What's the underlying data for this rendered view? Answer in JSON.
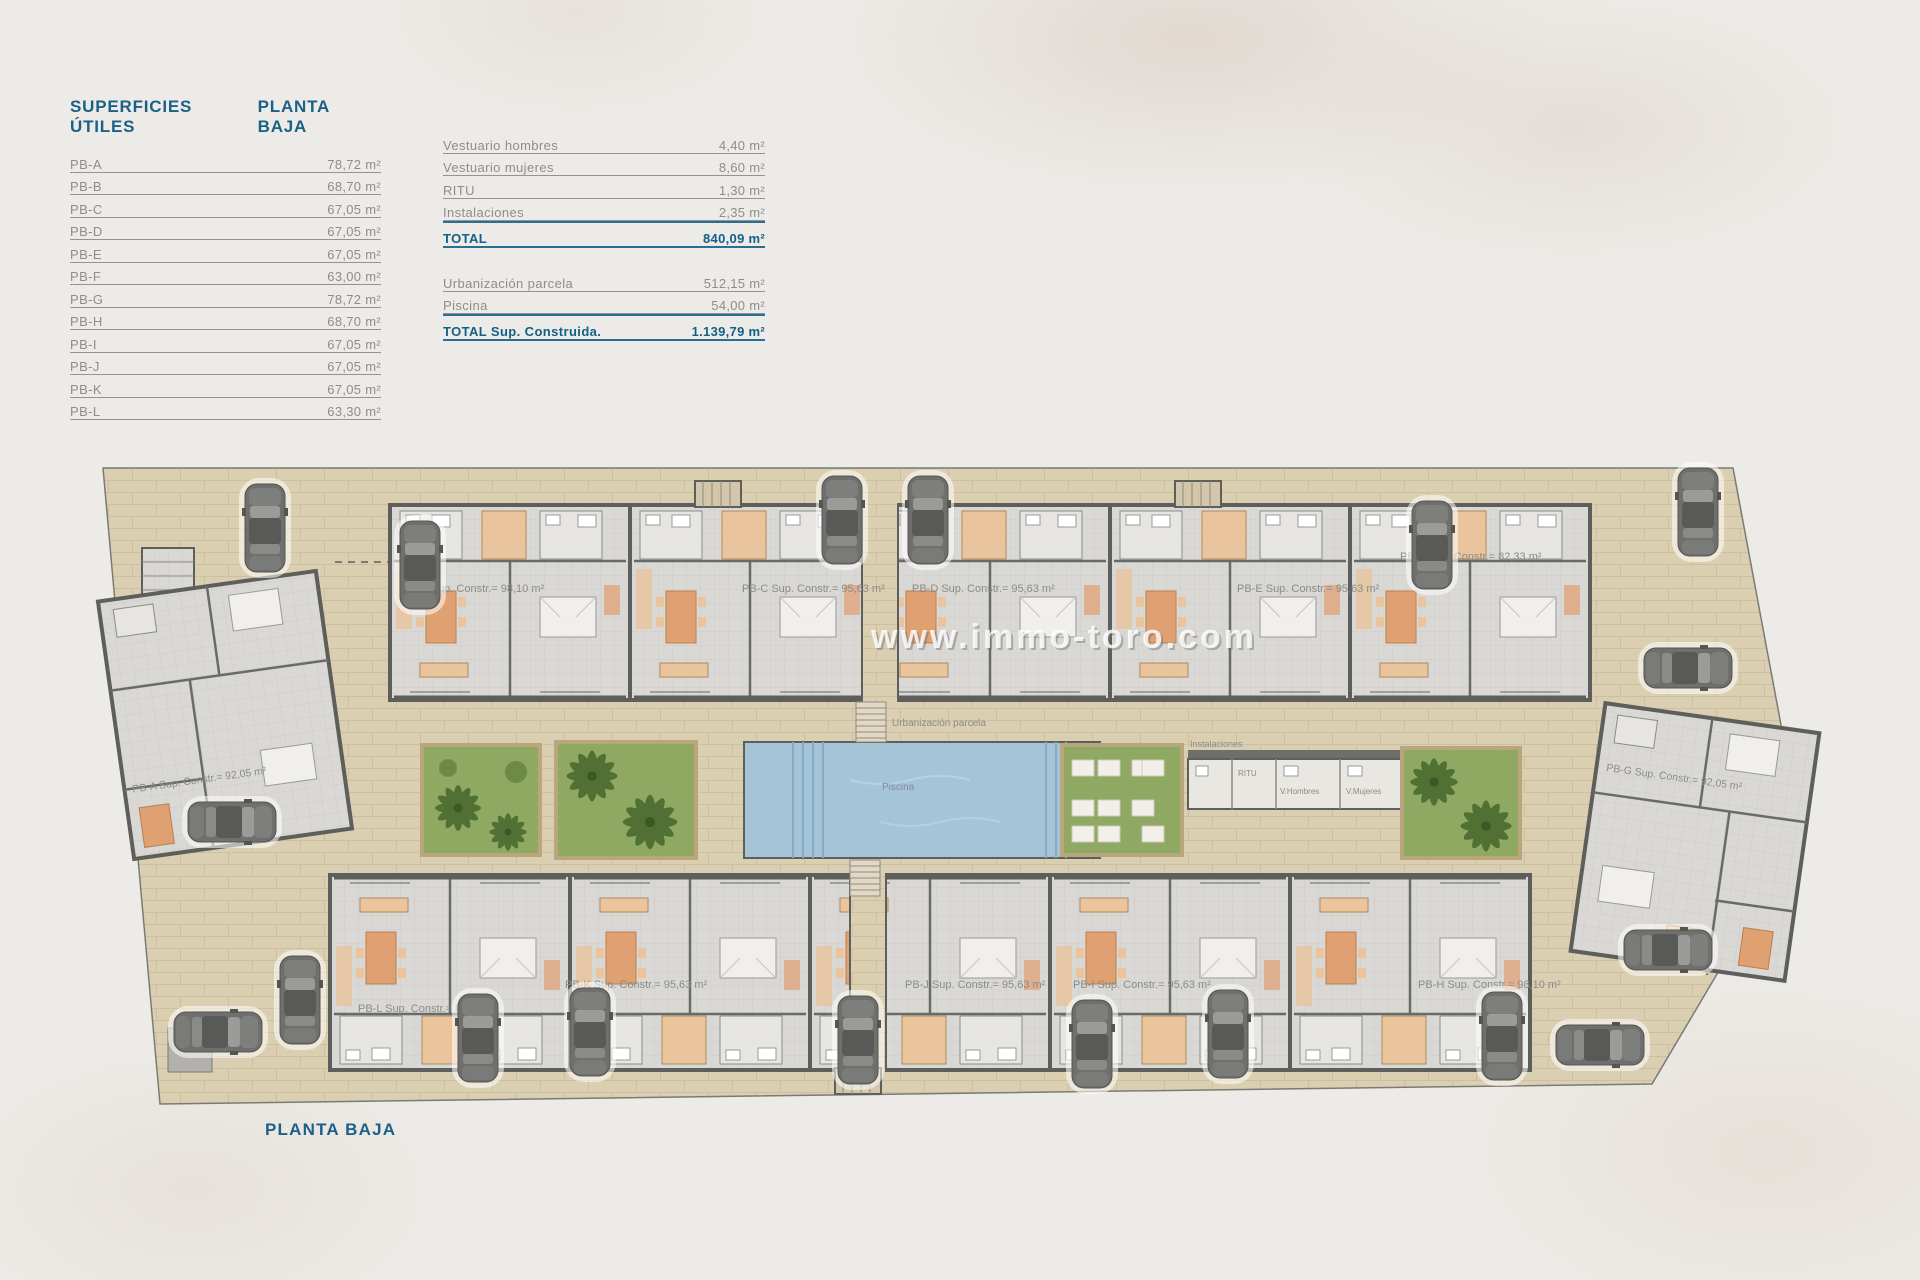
{
  "colors": {
    "accent_blue": "#1b6187",
    "site_beige": "#dbcfb2",
    "wall_gray": "#5e5e5c",
    "lawn_green": "#8fa963",
    "pool_blue": "#a6c4d8",
    "furniture_orange": "#dfa072"
  },
  "surfaces_table": {
    "title": "SUPERFICIES ÚTILES",
    "subtitle": "PLANTA BAJA",
    "rows": [
      {
        "label": "PB-A",
        "value": "78,72 m²"
      },
      {
        "label": "PB-B",
        "value": "68,70 m²"
      },
      {
        "label": "PB-C",
        "value": "67,05 m²"
      },
      {
        "label": "PB-D",
        "value": "67,05 m²"
      },
      {
        "label": "PB-E",
        "value": "67,05 m²"
      },
      {
        "label": "PB-F",
        "value": "63,00 m²"
      },
      {
        "label": "PB-G",
        "value": "78,72 m²"
      },
      {
        "label": "PB-H",
        "value": "68,70 m²"
      },
      {
        "label": "PB-I",
        "value": "67,05 m²"
      },
      {
        "label": "PB-J",
        "value": "67,05 m²"
      },
      {
        "label": "PB-K",
        "value": "67,05 m²"
      },
      {
        "label": "PB-L",
        "value": "63,30 m²"
      }
    ]
  },
  "summary_table": {
    "rows": [
      {
        "label": "Vestuario hombres",
        "value": "4,40 m²"
      },
      {
        "label": "Vestuario mujeres",
        "value": "8,60 m²"
      },
      {
        "label": "RITU",
        "value": "1,30 m²"
      },
      {
        "label": "Instalaciones",
        "value": "2,35 m²"
      }
    ],
    "total": {
      "label": "TOTAL",
      "value": "840,09 m²"
    },
    "rows2": [
      {
        "label": "Urbanización parcela",
        "value": "512,15 m²"
      },
      {
        "label": "Piscina",
        "value": "54,00 m²"
      }
    ],
    "total2": {
      "label": "TOTAL Sup. Construida.",
      "value": "1.139,79 m²"
    }
  },
  "plan": {
    "watermark": "www.immo-toro.com",
    "floor_label": "PLANTA BAJA",
    "labels": {
      "urbanizacion": "Urbanización parcela",
      "piscina": "Piscina",
      "instalaciones": "Instalaciones",
      "ritu": "RITU",
      "vestuario_hombres": "V.Hombres",
      "vestuario_mujeres": "V.Mujeres"
    },
    "units": [
      {
        "id": "PB-A",
        "label": "PB-A Sup. Constr.= 92,05 m²"
      },
      {
        "id": "PB-B",
        "label": "PB-B Sup. Constr.= 98,10 m²"
      },
      {
        "id": "PB-C",
        "label": "PB-C Sup. Constr.= 95,63 m²"
      },
      {
        "id": "PB-D",
        "label": "PB-D Sup. Constr.= 95,63 m²"
      },
      {
        "id": "PB-E",
        "label": "PB-E Sup. Constr.= 95,63 m²"
      },
      {
        "id": "PB-F",
        "label": "PB-F Sup. Constr.= 82,33 m²"
      },
      {
        "id": "PB-G",
        "label": "PB-G Sup. Constr.= 92,05 m²"
      },
      {
        "id": "PB-H",
        "label": "PB-H Sup. Constr.= 98,10 m²"
      },
      {
        "id": "PB-I",
        "label": "PB-I Sup. Constr.= 95,63 m²"
      },
      {
        "id": "PB-J",
        "label": "PB-J Sup. Constr.= 95,63 m²"
      },
      {
        "id": "PB-K",
        "label": "PB-K Sup. Constr.= 95,63 m²"
      },
      {
        "id": "PB-L",
        "label": "PB-L Sup. Constr.= 82,33 m²"
      }
    ]
  }
}
